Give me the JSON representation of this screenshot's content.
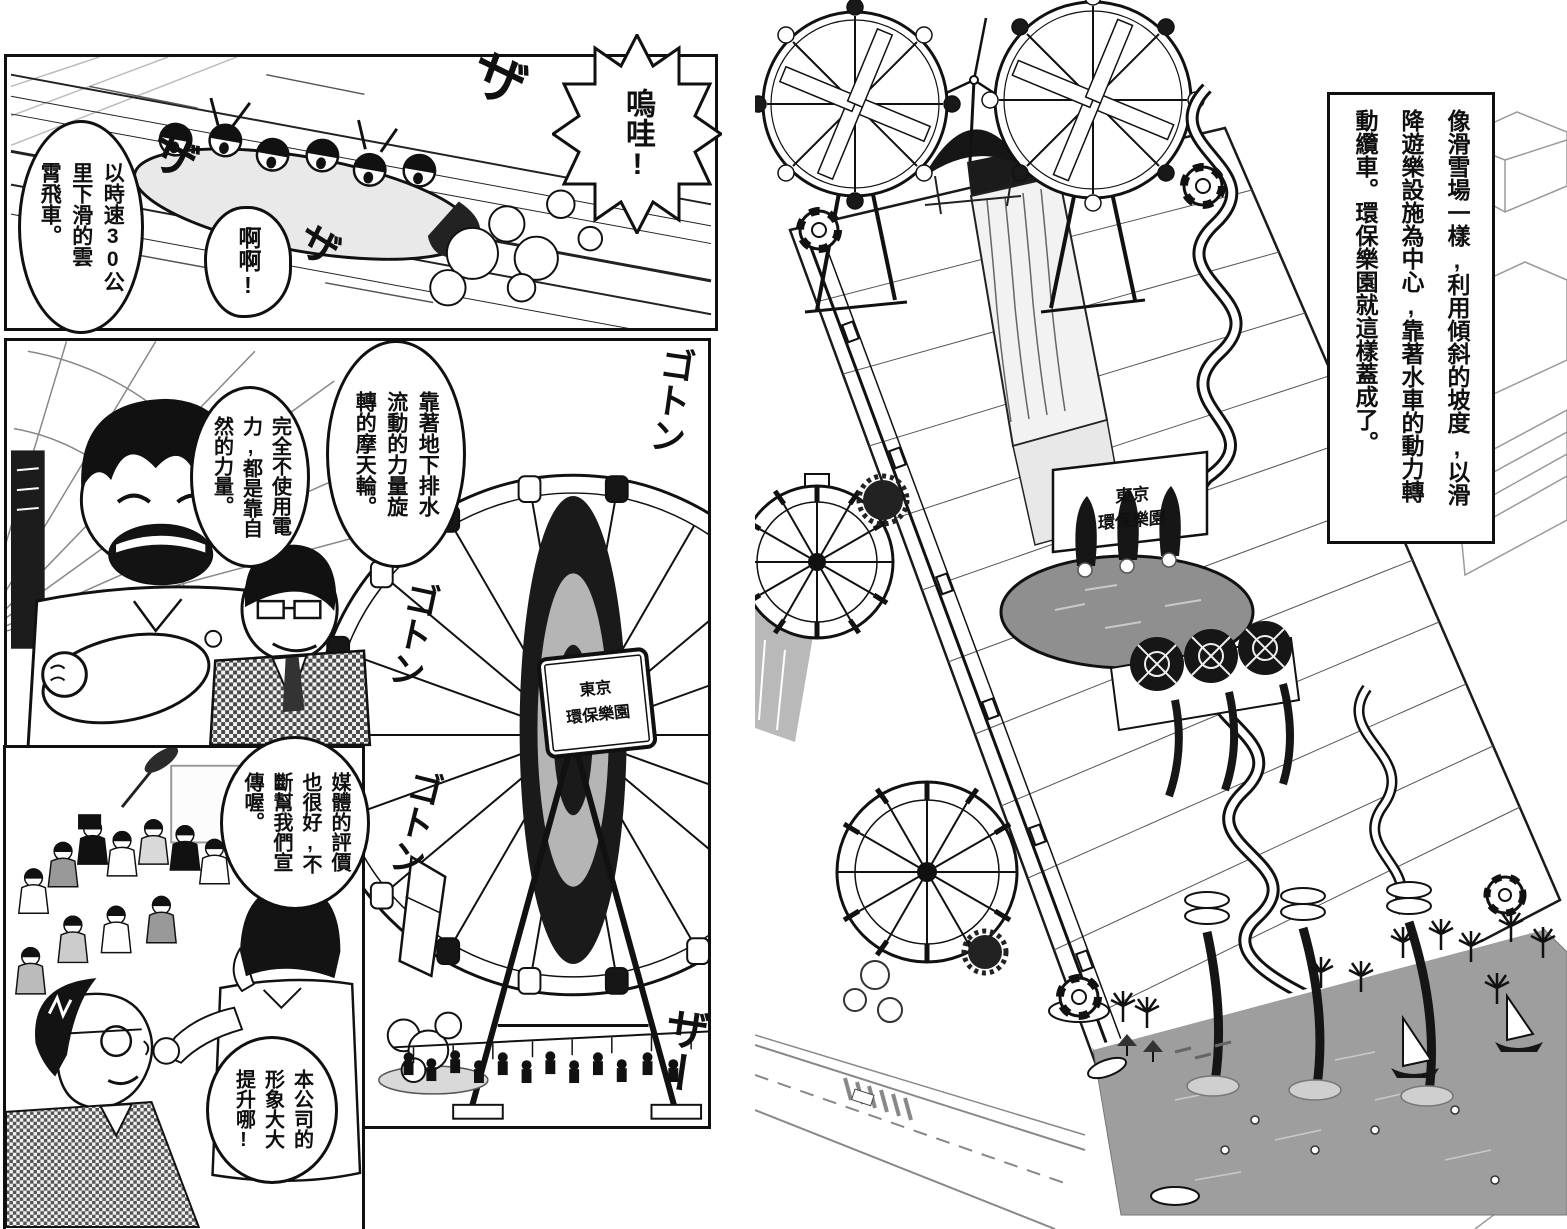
{
  "left_page": {
    "panel1": {
      "bubble_speed": "以時速30公\n里下滑的雲\n霄飛車。",
      "bubble_wow": "嗚哇!",
      "bubble_ahh": "啊啊!",
      "sfx_za_1": "ザ",
      "sfx_za_2": "ザ",
      "sfx_za_3": "ザ"
    },
    "panel2": {
      "bubble_wheel": "靠著地下排水\n流動的力量旋\n轉的摩天輪。",
      "bubble_power": "完全不使用電\n力,都是靠自\n然的力量。",
      "hub_sign": "東京\n環保樂園",
      "sfx_goton_1": "ゴトン",
      "sfx_goton_2": "ゴトン",
      "sfx_goton_3": "ゴトン",
      "sfx_zaa": "ザー"
    },
    "panel3": {
      "bubble_media": "媒體的評價\n也很好,不\n斷幫我們宣\n傳喔。",
      "bubble_image": "本公司的\n形象大大\n提升哪!"
    }
  },
  "right_page": {
    "caption": "像滑雪場一樣,利用傾斜的坡度,以滑\n降遊樂設施為中心,靠著水車的動力轉\n動纜車。環保樂園就這樣蓋成了。",
    "park_sign": "東京\n環保樂園"
  },
  "colors": {
    "ink": "#101010",
    "paper": "#ffffff",
    "water_gray": "#9e9e9e",
    "halftone_gray": "#b5b5b5"
  }
}
